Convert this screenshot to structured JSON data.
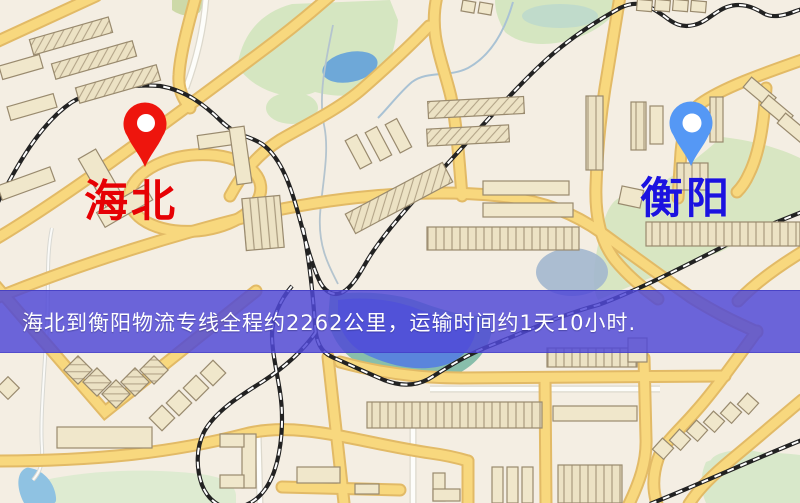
{
  "markers": {
    "origin": {
      "label": "海北",
      "label_color": "#e60104",
      "pin_color": "#ee150d",
      "pin_hole_color": "#ffffff"
    },
    "destination": {
      "label": "衡阳",
      "label_color": "#1b12e0",
      "pin_color": "#5598f5",
      "pin_hole_color": "#ffffff"
    }
  },
  "banner": {
    "text": "海北到衡阳物流专线全程约2262公里，运输时间约1天10小时.",
    "background_color": "#5049d6",
    "opacity": "0.84",
    "text_color": "#ffffff"
  },
  "map_palette": {
    "background": "#f4eee3",
    "road": "#f8d87e",
    "road_casing": "#e2ba66",
    "minor_road": "#fdfdfa",
    "railway": "#222222",
    "railway_dash": "#ffffff",
    "park_green": "#d5e6c1",
    "teal_green": "#c0dbcb",
    "field_green": "#deebd1",
    "lake_blue": "#6ea8d8",
    "pond_blue": "#8fc2e2",
    "river_blue": "#5a85dc",
    "building_fill": "#f0e7cb",
    "building_outline": "#998a6e"
  }
}
